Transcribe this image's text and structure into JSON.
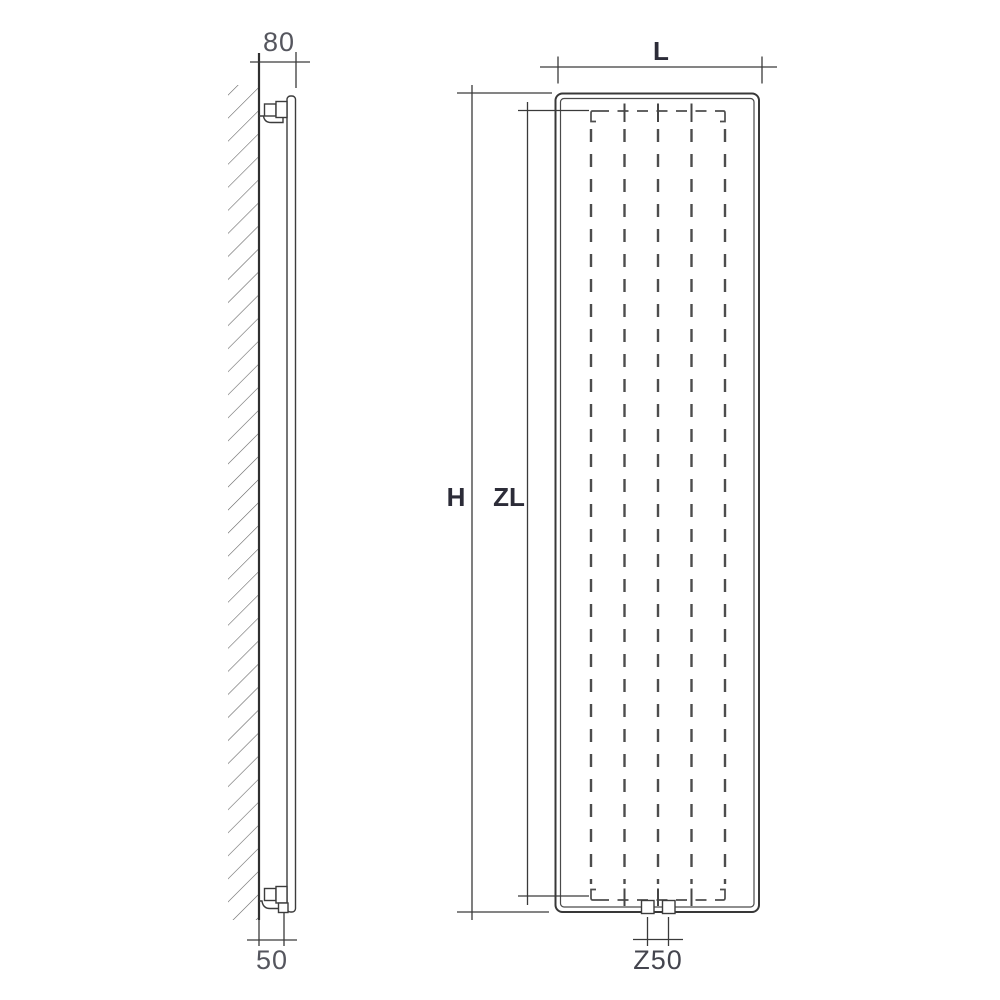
{
  "diagram": {
    "type": "technical-drawing",
    "subject": "vertical panel radiator - side elevation and front elevation with dimension lines",
    "side_view": {
      "top_dimension_label": "80",
      "bottom_dimension_label": "50"
    },
    "front_view": {
      "width_dimension_label": "L",
      "height_dimension_label": "H",
      "convector_height_dimension_label": "ZL",
      "connection_spacing_label": "Z50"
    }
  },
  "colors": {
    "background": "#ffffff",
    "line": "#3a3a3a",
    "hatch": "#616161",
    "dashed": "#4d4d4d",
    "text_dark": "#2c2c38",
    "text_light": "#55565e",
    "text_mid": "#44454e"
  }
}
